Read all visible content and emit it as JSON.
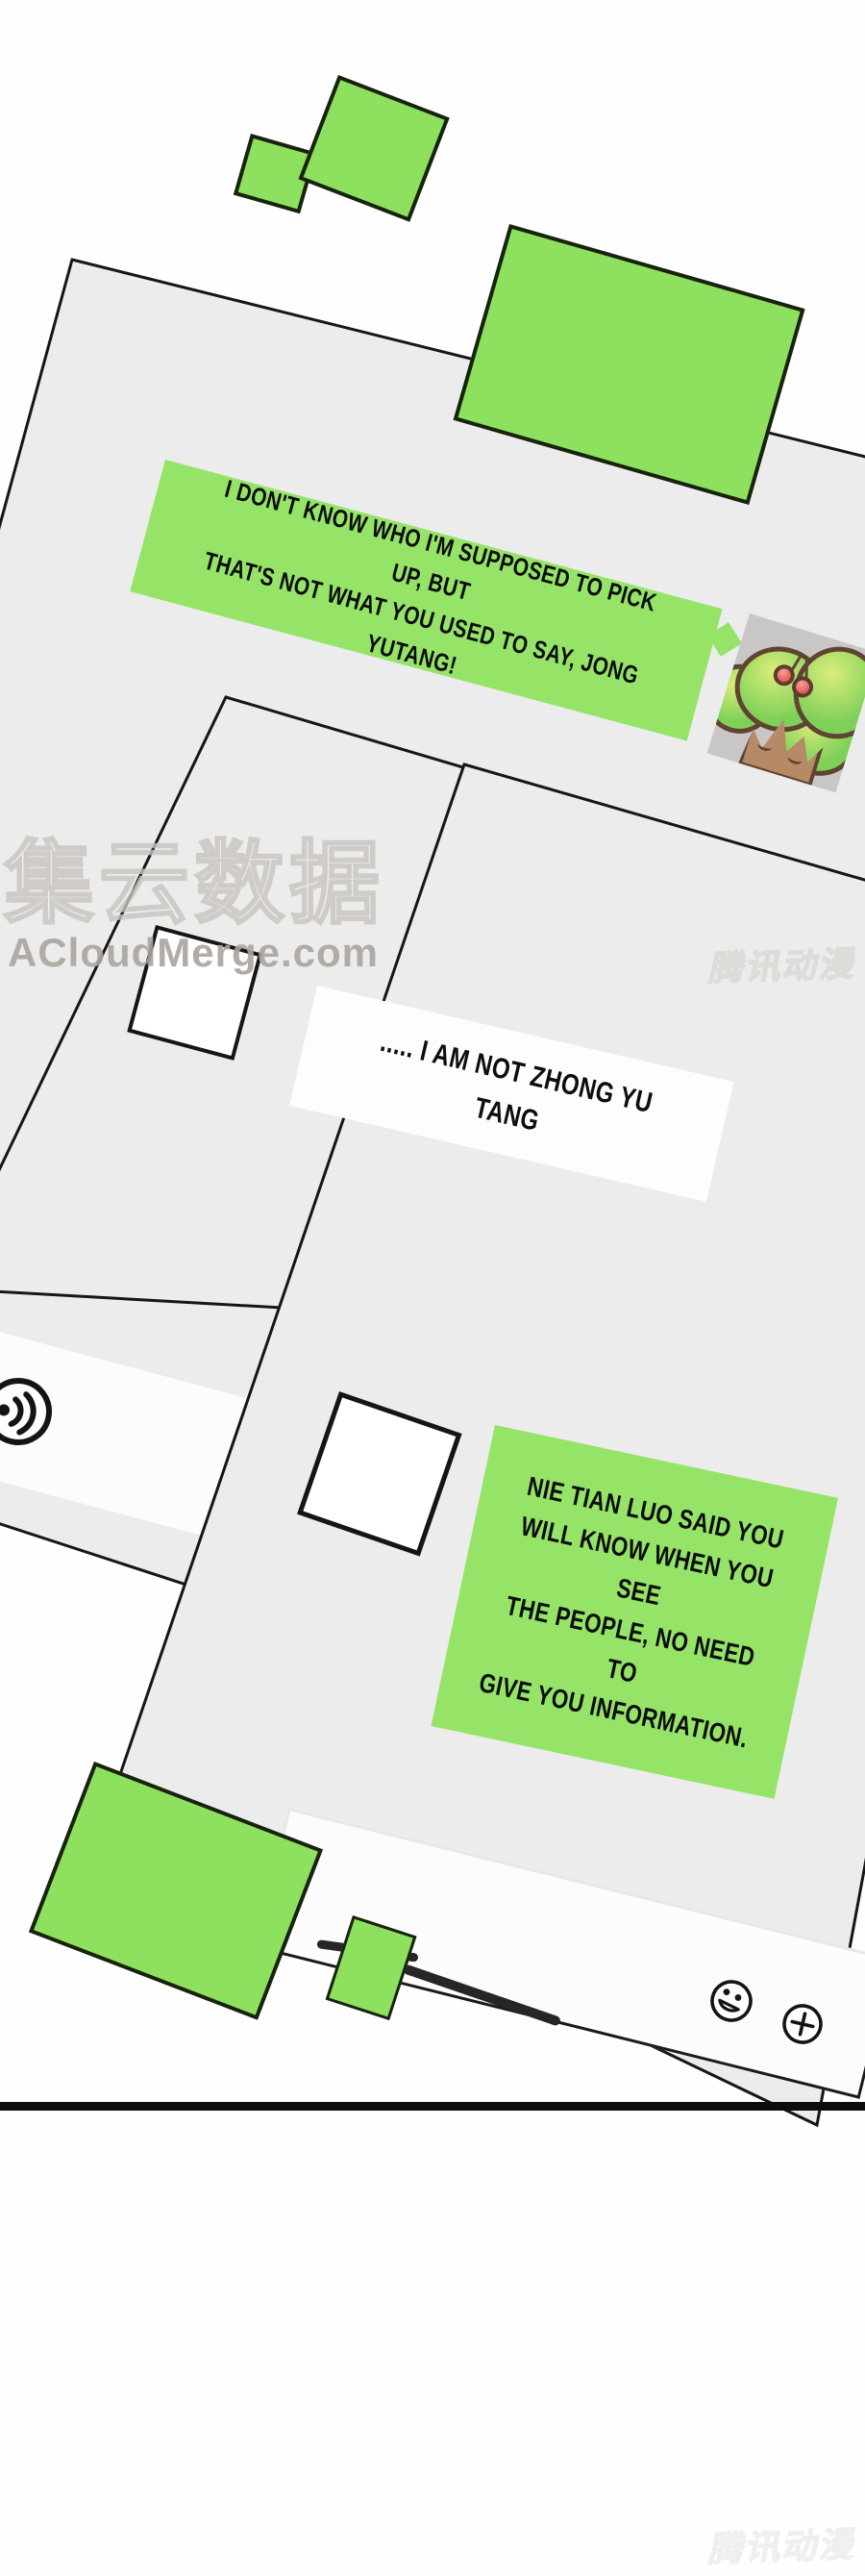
{
  "comic": {
    "bubbles": {
      "bubble1": "I DON'T KNOW WHO I'M SUPPOSED TO PICK UP, BUT\nTHAT'S NOT WHAT YOU USED TO SAY, JONG YUTANG!",
      "bubble2": "..... I AM NOT ZHONG YU TANG",
      "bubble3": "NIE TIAN LUO SAID YOU\nWILL KNOW WHEN YOU SEE\nTHE PEOPLE, NO NEED TO\nGIVE YOU INFORMATION."
    },
    "watermarks": {
      "brand_cn": "集云数据",
      "brand_site": "ACloudMerge.com",
      "platform_mid": "腾讯动漫",
      "platform_bottom": "腾讯动漫"
    },
    "icons": {
      "voice": "voice-message-icon",
      "emoji": "emoji-smiley-icon",
      "add": "add-plus-icon"
    },
    "colors": {
      "panel_gray": "#ececec",
      "shape_green": "#8de15e",
      "bubble_green": "#95e468",
      "ink": "#161616"
    }
  }
}
